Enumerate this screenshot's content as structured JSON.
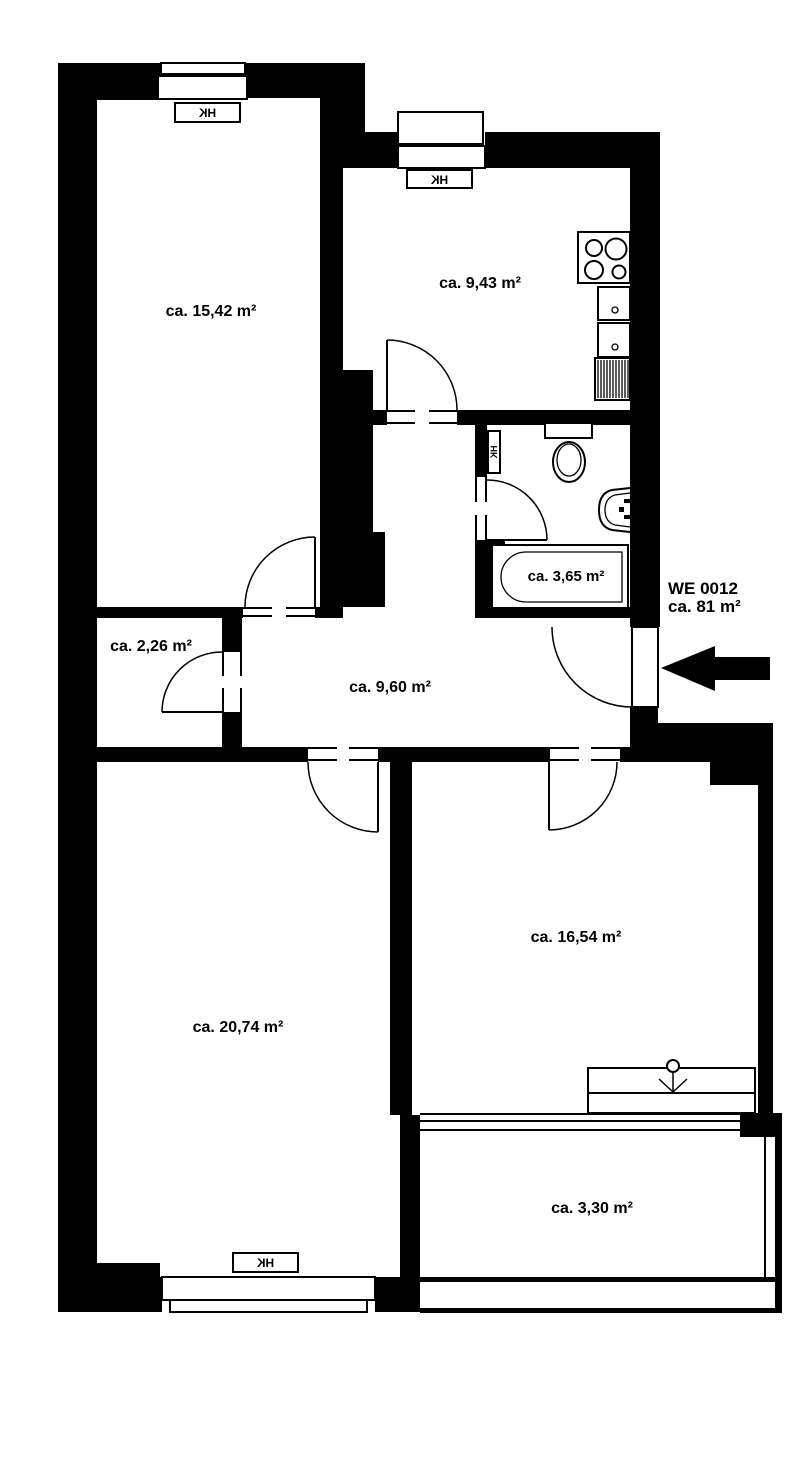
{
  "plan": {
    "unit": {
      "label": "WE 0012",
      "area": "ca. 81 m²"
    },
    "rooms": [
      {
        "name": "room-top-left",
        "area_label": "ca. 15,42 m²"
      },
      {
        "name": "kitchen",
        "area_label": "ca. 9,43 m²"
      },
      {
        "name": "bathroom",
        "area_label": "ca. 3,65 m²"
      },
      {
        "name": "storage",
        "area_label": "ca. 2,26 m²"
      },
      {
        "name": "hallway",
        "area_label": "ca. 9,60 m²"
      },
      {
        "name": "room-bottom-left",
        "area_label": "ca. 20,74 m²"
      },
      {
        "name": "room-bottom-right",
        "area_label": "ca. 16,54 m²"
      },
      {
        "name": "balcony",
        "area_label": "ca. 3,30 m²"
      }
    ],
    "radiator_label": "HK",
    "colors": {
      "wall": "#000000",
      "background": "#ffffff"
    }
  }
}
